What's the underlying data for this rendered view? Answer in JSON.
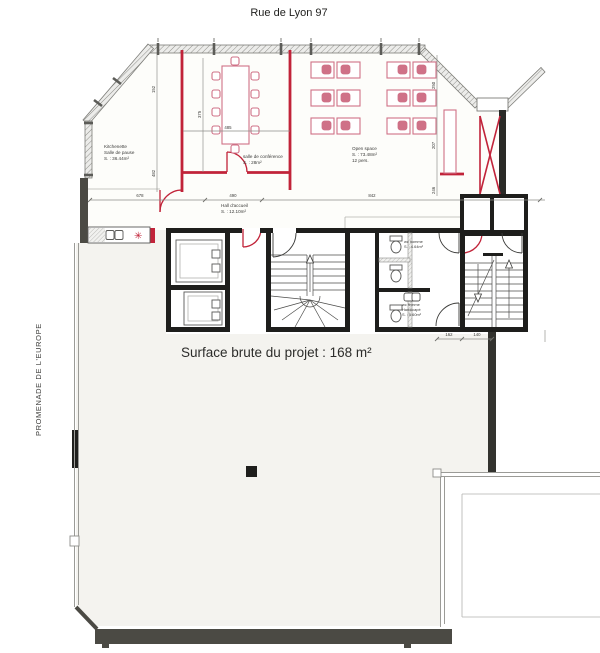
{
  "header": {
    "title": "Rue de Lyon 97"
  },
  "side": {
    "street": "PROMENADE DE L'EUROPE"
  },
  "note": {
    "surface": "Surface brute du projet : 168 m²"
  },
  "rooms": {
    "kitchenette": {
      "l1": "Kitchenette",
      "l2": "Salle de pause",
      "l3": "S. : 36.44m²"
    },
    "conference": {
      "l1": "salle de conférence",
      "l2": "S. : 28m²"
    },
    "open_space": {
      "l1": "Open space",
      "l2": "S. : 73.48m²",
      "l3": "12 pers."
    },
    "hall": {
      "l1": "Hall d'accueil",
      "l2": "S. : 12.10m²"
    },
    "wc_homme": {
      "l1": "wc homme",
      "l2": "S. : 4.64m²"
    },
    "wc_femme": {
      "l1": "wc femme",
      "l2": "Handicapé",
      "l3": "S. : 5.60m²"
    }
  },
  "dims": {
    "w1": "678",
    "w2": "490",
    "w3": "842",
    "table": "485",
    "v1": "375",
    "v2": "152",
    "v3": "482",
    "r1": "250",
    "r2": "207",
    "r3": "246",
    "s1": "162",
    "s2": "140"
  },
  "colors": {
    "wall_red": "#c12339",
    "pink": "#cf7187",
    "ink": "#1e1e1c",
    "wall_dark": "#4b4a44",
    "floor": "#f4f3ef"
  }
}
